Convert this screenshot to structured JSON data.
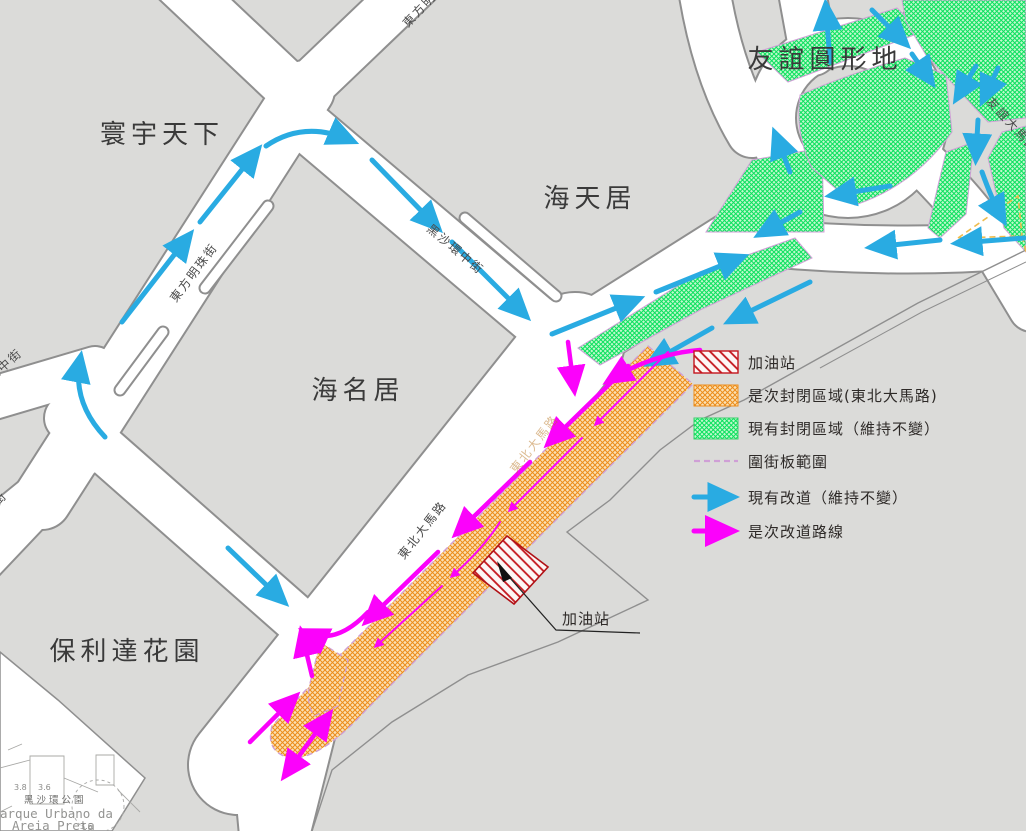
{
  "title": "交通改道示意圖",
  "places": {
    "la_cite": "寰宇天下",
    "hoi_tin": "海天居",
    "roundabout": "友誼圓形地",
    "hoi_meng": "海名居",
    "polytec": "保利達花園",
    "gas_callout": "加油站"
  },
  "streets": {
    "pearl": "東方明珠街",
    "central": "黑沙環中街",
    "nordeste": "東北大馬路",
    "nordeste_faint": "東北大馬路",
    "pearl_top": "東方明珠街",
    "amizade": "友誼大馬路",
    "left_upper": "環中街",
    "left_lower": "街"
  },
  "park": {
    "elev_a": "3.8",
    "elev_b": "3.6",
    "elev_c": "3.6",
    "name_cn": "黑沙環公園",
    "name_pt1": "arque Urbano da",
    "name_pt2": "Areia Preta"
  },
  "legend": {
    "items": [
      {
        "key": "gas-station",
        "swatch": "red-hatch",
        "label": "加油站"
      },
      {
        "key": "new-closed-area",
        "swatch": "orange-hatch",
        "label": "是次封閉區域(東北大馬路)"
      },
      {
        "key": "existing-closed-area",
        "swatch": "green-hatch",
        "label": "現有封閉區域（維持不變）"
      },
      {
        "key": "hoarding-extent",
        "swatch": "violet-dashed-line",
        "label": "圍街板範圍"
      },
      {
        "key": "existing-diversion",
        "swatch": "blue-arrow",
        "label": "現有改道（維持不變）"
      },
      {
        "key": "new-diversion-route",
        "swatch": "magenta-arrow",
        "label": "是次改道路線"
      }
    ]
  },
  "colors": {
    "block_gray": "#dbdbd9",
    "road_white": "#ffffff",
    "casing_gray": "#8f8f8f",
    "existing_diversion_blue": "#29abe2",
    "new_diversion_magenta": "#fb02fb",
    "closed_green": "#0ae05e",
    "closed_orange": "#ee8a00",
    "gas_red": "#c4161d",
    "hoarding_violet": "#cf9fd6",
    "guide_dash_yellow": "#eebc4e"
  }
}
